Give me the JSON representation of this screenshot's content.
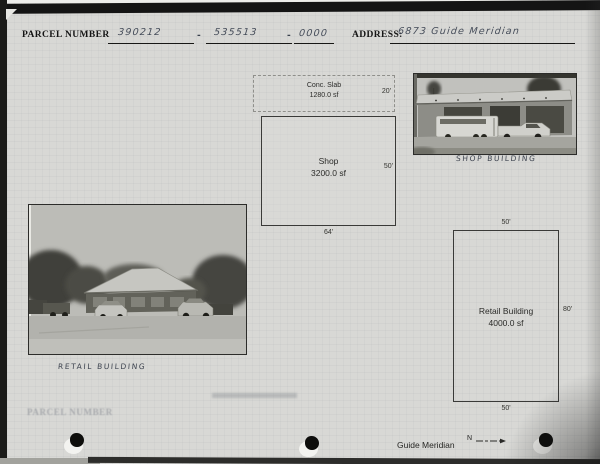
{
  "header": {
    "parcel_label": "PARCEL NUMBER",
    "parcel_segments": [
      "390212",
      "535513",
      "0000"
    ],
    "separator": "-",
    "address_label": "ADDRESS:",
    "address_value": "6873 Guide Meridian"
  },
  "footprints": {
    "conc_slab": {
      "label": "Conc. Slab",
      "area": "1280.0 sf",
      "side": "20'"
    },
    "shop": {
      "label": "Shop",
      "area": "3200.0 sf",
      "side": "50'",
      "base": "64'"
    },
    "retail": {
      "label": "Retail Building",
      "area": "4000.0 sf",
      "top": "50'",
      "side": "80'",
      "bottom": "50'"
    }
  },
  "photos": {
    "shop_caption": "SHOP BUILDING",
    "retail_caption": "RETAIL BUILDING"
  },
  "footer": {
    "road": "Guide Meridian",
    "compass": "N"
  },
  "bleed_through": {
    "text": "PARCEL NUMBER"
  },
  "colors": {
    "paper": "#d8d8d5",
    "ink": "#1a1a1a",
    "pencil": "#454c59"
  }
}
